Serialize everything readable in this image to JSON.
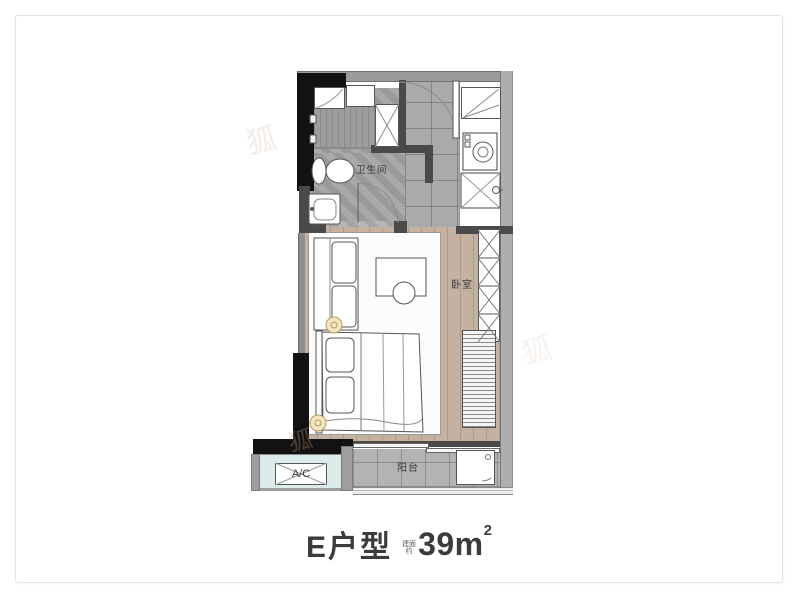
{
  "title": {
    "name": "E户型",
    "area_note_top": "建面",
    "area_note_bottom": "约",
    "area_value": "39m",
    "area_sup": "2"
  },
  "rooms": {
    "bathroom": "卫生间",
    "bedroom": "卧室",
    "balcony": "阳台",
    "ac_unit": "A/C"
  },
  "watermark": {
    "glyph": "狐"
  },
  "colors": {
    "wall_gray": "#9b9b9b",
    "wall_dark": "#4a4a4a",
    "wall_black": "#121212",
    "wood": "#c3b2a2",
    "ac_platform": "#dcecea",
    "lamp_fill": "#f3e7c3",
    "title_text": "#3b3b3b"
  }
}
